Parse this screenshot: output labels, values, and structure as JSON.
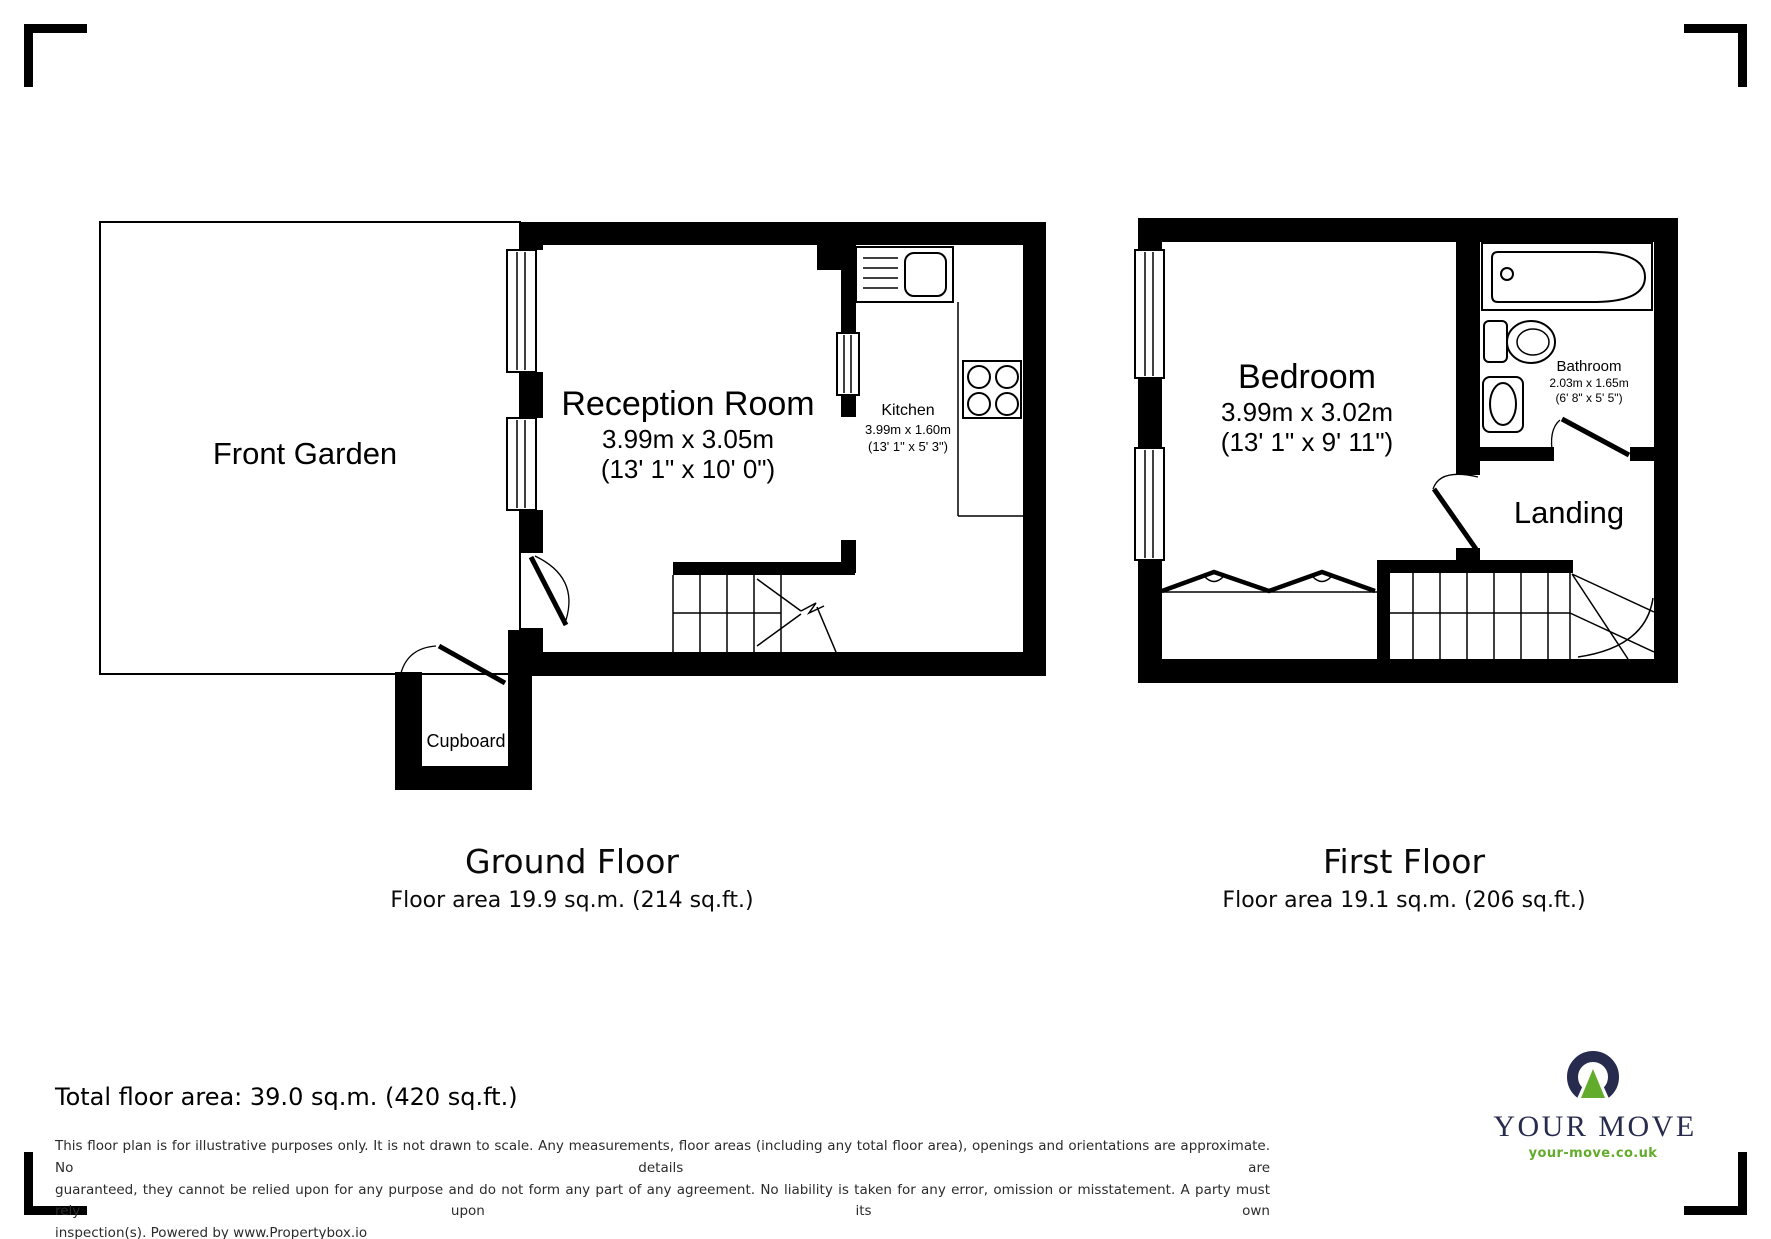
{
  "page": {
    "background": "#ffffff"
  },
  "ground_floor": {
    "caption_title": "Ground Floor",
    "caption_area": "Floor area 19.9 sq.m. (214 sq.ft.)",
    "front_garden": {
      "name": "Front Garden"
    },
    "reception_room": {
      "name": "Reception Room",
      "size_metric": "3.99m x 3.05m",
      "size_imperial": "(13' 1\" x 10' 0\")"
    },
    "kitchen": {
      "name": "Kitchen",
      "size_metric": "3.99m x 1.60m",
      "size_imperial": "(13' 1\" x 5' 3\")"
    },
    "cupboard": {
      "name": "Cupboard"
    }
  },
  "first_floor": {
    "caption_title": "First Floor",
    "caption_area": "Floor area 19.1 sq.m. (206 sq.ft.)",
    "bedroom": {
      "name": "Bedroom",
      "size_metric": "3.99m x 3.02m",
      "size_imperial": "(13' 1\" x 9' 11\")"
    },
    "bathroom": {
      "name": "Bathroom",
      "size_metric": "2.03m x 1.65m",
      "size_imperial": "(6' 8\" x 5' 5\")"
    },
    "landing": {
      "name": "Landing"
    }
  },
  "footer": {
    "total_area": "Total floor area: 39.0 sq.m. (420 sq.ft.)",
    "disclaimer_lines": [
      "This floor plan is for illustrative purposes only. It is not drawn to scale. Any measurements, floor areas (including any total floor area), openings and orientations are approximate. No details are",
      "guaranteed, they cannot be relied upon for any purpose and do not form any part of any agreement. No liability is taken for any error, omission or misstatement. A party must rely upon its own",
      "inspection(s). Powered by www.Propertybox.io"
    ]
  },
  "logo": {
    "brand": "YOUR MOVE",
    "website": "your-move.co.uk",
    "navy": "#272b4d",
    "green": "#62ab2b"
  }
}
